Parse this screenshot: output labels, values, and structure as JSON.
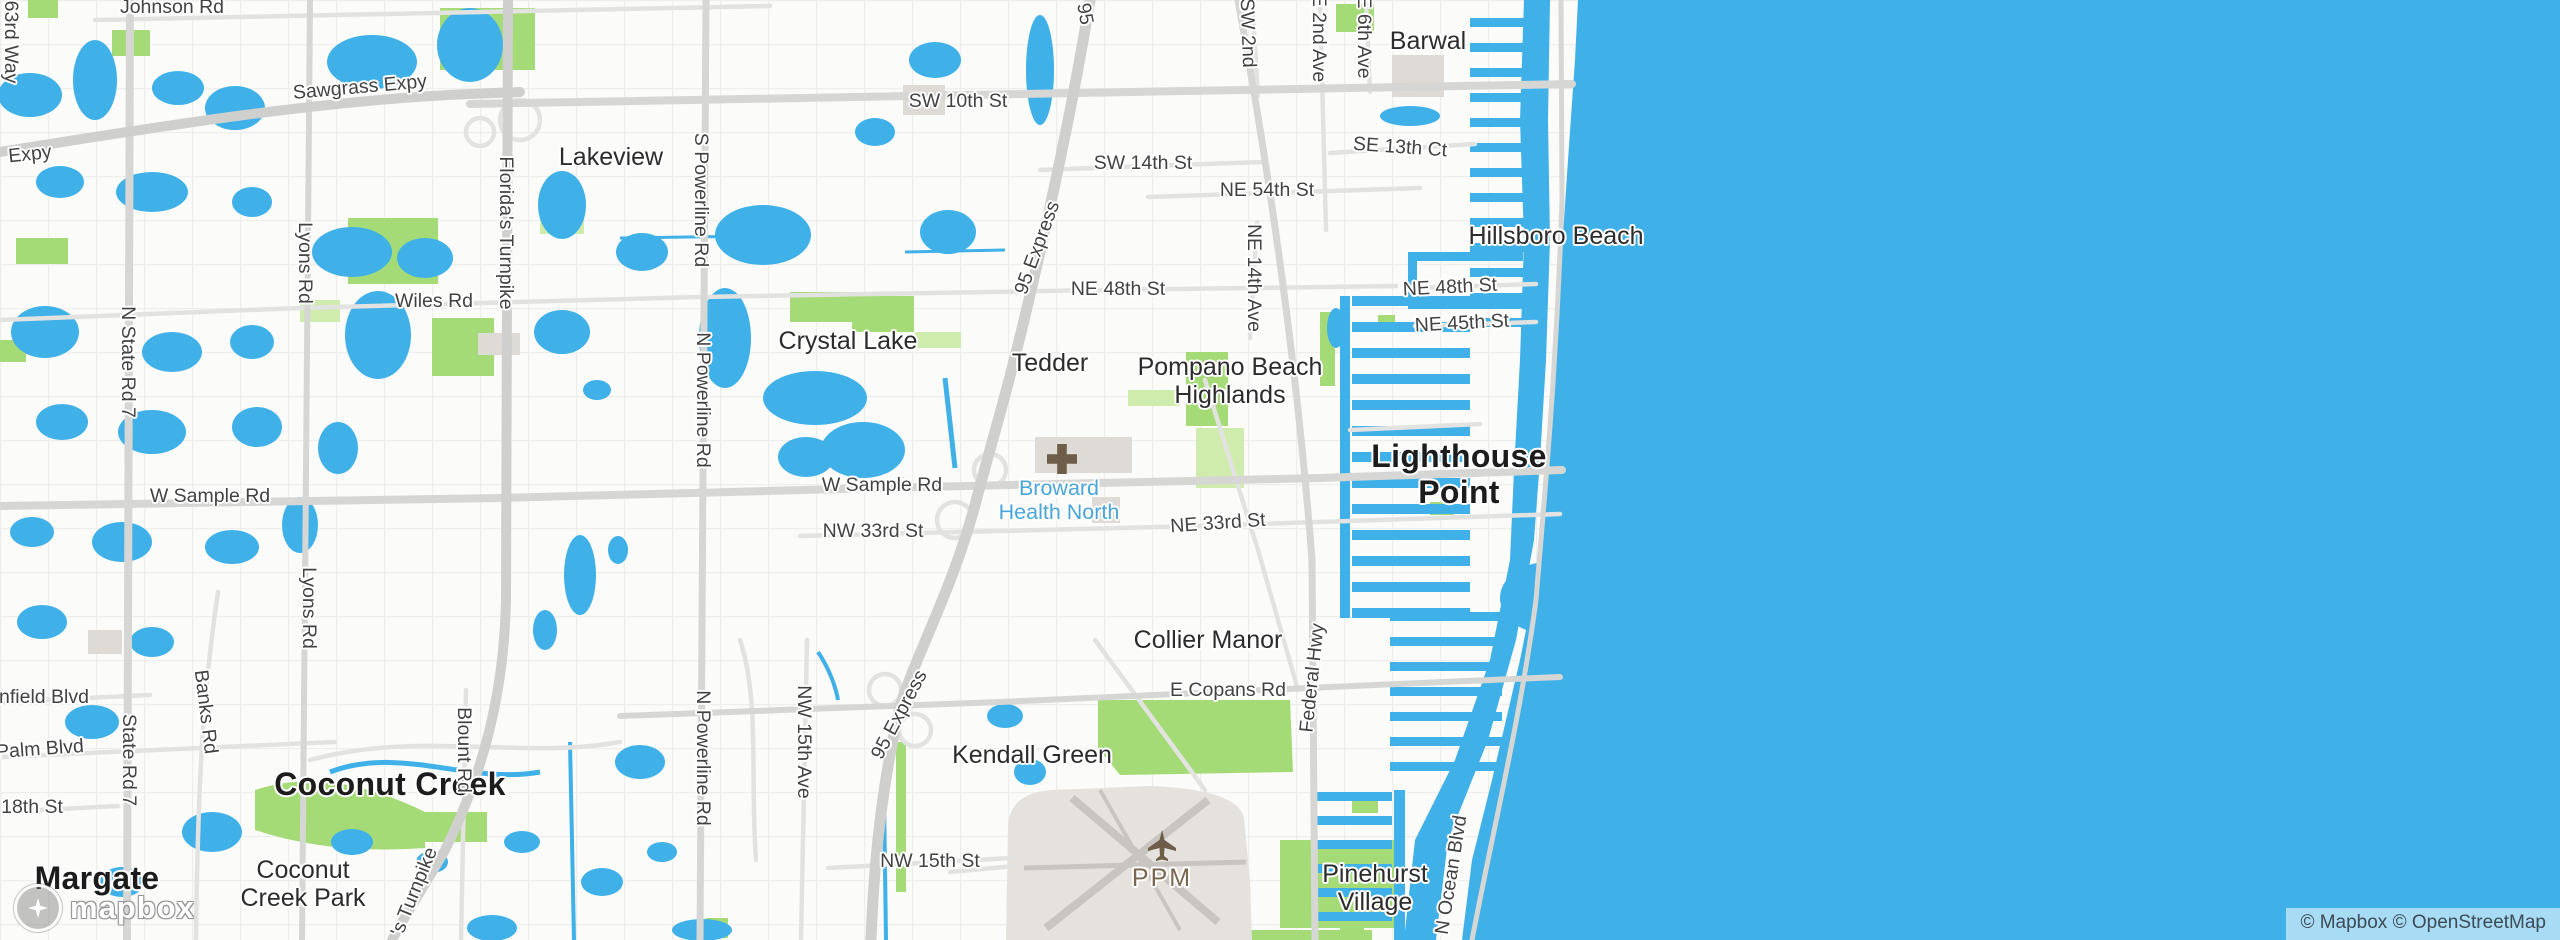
{
  "map": {
    "attribution": "© Mapbox © OpenStreetMap",
    "logo_text": "mapbox",
    "colors": {
      "water": "#3FB1E8",
      "land": "#FBFBF9",
      "park": "#A5DB76",
      "park_light": "#D0ECAD",
      "road": "#D6D6D4",
      "airport_ground": "#E5E2DE",
      "city_label": "#1c1c1c",
      "road_label": "#424242",
      "hospital_label": "#4AA5DA",
      "airport_label": "#7A6750",
      "poi_icon_brown": "#6E5E49"
    },
    "labels": [
      {
        "t": "Margate",
        "x": 97,
        "y": 879,
        "c": "city"
      },
      {
        "t": "Coconut Creek",
        "x": 390,
        "y": 785,
        "c": "city"
      },
      {
        "t": "Lighthouse\nPoint",
        "x": 1459,
        "y": 475,
        "c": "city"
      },
      {
        "t": "Barwal",
        "x": 1428,
        "y": 41,
        "c": "town"
      },
      {
        "t": "Hillsboro Beach",
        "x": 1556,
        "y": 236,
        "c": "town"
      },
      {
        "t": "Lakeview",
        "x": 611,
        "y": 157,
        "c": "town"
      },
      {
        "t": "Crystal Lake",
        "x": 848,
        "y": 341,
        "c": "town"
      },
      {
        "t": "Tedder",
        "x": 1050,
        "y": 363,
        "c": "town"
      },
      {
        "t": "Pompano Beach\nHighlands",
        "x": 1230,
        "y": 381,
        "c": "town"
      },
      {
        "t": "Collier Manor",
        "x": 1208,
        "y": 640,
        "c": "town"
      },
      {
        "t": "Kendall Green",
        "x": 1032,
        "y": 755,
        "c": "town"
      },
      {
        "t": "Coconut\nCreek Park",
        "x": 303,
        "y": 884,
        "c": "town"
      },
      {
        "t": "Pinehurst\nVillage",
        "x": 1375,
        "y": 888,
        "c": "town"
      },
      {
        "t": "Johnson Rd",
        "x": 172,
        "y": 8,
        "c": "road"
      },
      {
        "t": "Sawgrass Expy",
        "x": 360,
        "y": 88,
        "r": -5,
        "c": "road"
      },
      {
        "t": "Expy",
        "x": 30,
        "y": 155,
        "r": -6,
        "c": "road"
      },
      {
        "t": "SW 10th St",
        "x": 958,
        "y": 102,
        "c": "road"
      },
      {
        "t": "SW 14th St",
        "x": 1143,
        "y": 164,
        "c": "road"
      },
      {
        "t": "NE 54th St",
        "x": 1267,
        "y": 191,
        "c": "road"
      },
      {
        "t": "SE 13th Ct",
        "x": 1400,
        "y": 148,
        "r": 4,
        "c": "road"
      },
      {
        "t": "Wiles Rd",
        "x": 434,
        "y": 302,
        "c": "road"
      },
      {
        "t": "NE 48th St",
        "x": 1118,
        "y": 290,
        "c": "road"
      },
      {
        "t": "NE 48th St",
        "x": 1450,
        "y": 288,
        "r": -3,
        "c": "road"
      },
      {
        "t": "NE 45th St",
        "x": 1462,
        "y": 324,
        "r": -3,
        "c": "road"
      },
      {
        "t": "W Sample Rd",
        "x": 210,
        "y": 497,
        "c": "road"
      },
      {
        "t": "W Sample Rd",
        "x": 882,
        "y": 486,
        "c": "road"
      },
      {
        "t": "NW 33rd St",
        "x": 873,
        "y": 532,
        "c": "road"
      },
      {
        "t": "NE 33rd St",
        "x": 1218,
        "y": 524,
        "r": -4,
        "c": "road"
      },
      {
        "t": "E Copans Rd",
        "x": 1228,
        "y": 691,
        "c": "road"
      },
      {
        "t": "NW 15th St",
        "x": 930,
        "y": 862,
        "c": "road"
      },
      {
        "t": "18th St",
        "x": 32,
        "y": 808,
        "c": "road"
      },
      {
        "t": "nfield Blvd",
        "x": 44,
        "y": 698,
        "c": "road"
      },
      {
        "t": "Palm Blvd",
        "x": 40,
        "y": 750,
        "r": -4,
        "c": "road"
      },
      {
        "t": "63rd Way",
        "x": 10,
        "y": 42,
        "r": 90,
        "c": "road"
      },
      {
        "t": "N State Rd 7",
        "x": 127,
        "y": 362,
        "r": 90,
        "c": "road"
      },
      {
        "t": "State Rd 7",
        "x": 128,
        "y": 760,
        "r": 90,
        "c": "road"
      },
      {
        "t": "Lyons Rd",
        "x": 304,
        "y": 263,
        "r": 90,
        "c": "road"
      },
      {
        "t": "Lyons Rd",
        "x": 308,
        "y": 608,
        "r": 90,
        "c": "road"
      },
      {
        "t": "Banks Rd",
        "x": 205,
        "y": 712,
        "r": 83,
        "c": "road"
      },
      {
        "t": "Florida's Turnpike",
        "x": 505,
        "y": 233,
        "r": 90,
        "c": "road"
      },
      {
        "t": "'s Turnpike",
        "x": 415,
        "y": 892,
        "r": -68,
        "c": "road"
      },
      {
        "t": "Blount Rd",
        "x": 463,
        "y": 750,
        "r": 90,
        "c": "road"
      },
      {
        "t": "S Powerline Rd",
        "x": 700,
        "y": 200,
        "r": 90,
        "c": "road"
      },
      {
        "t": "N Powerline Rd",
        "x": 702,
        "y": 400,
        "r": 90,
        "c": "road"
      },
      {
        "t": "N Powerline Rd",
        "x": 702,
        "y": 758,
        "r": 90,
        "c": "road"
      },
      {
        "t": "NW 15th Ave",
        "x": 803,
        "y": 742,
        "r": 90,
        "c": "road"
      },
      {
        "t": "95",
        "x": 1084,
        "y": 14,
        "r": 80,
        "c": "road"
      },
      {
        "t": "95 Express",
        "x": 1038,
        "y": 248,
        "r": -70,
        "c": "road"
      },
      {
        "t": "95 Express",
        "x": 900,
        "y": 715,
        "r": -62,
        "c": "road"
      },
      {
        "t": "NE 14th Ave",
        "x": 1253,
        "y": 278,
        "r": 90,
        "c": "road"
      },
      {
        "t": "Federal Hwy",
        "x": 1313,
        "y": 678,
        "r": -84,
        "c": "road"
      },
      {
        "t": "E 2nd Ave",
        "x": 1318,
        "y": 38,
        "r": 90,
        "c": "road"
      },
      {
        "t": "E 6th Ave",
        "x": 1363,
        "y": 37,
        "r": 90,
        "c": "road"
      },
      {
        "t": "SW 2nd",
        "x": 1247,
        "y": 33,
        "r": 88,
        "c": "road"
      },
      {
        "t": "N Ocean Blvd",
        "x": 1452,
        "y": 875,
        "r": -81,
        "c": "road"
      },
      {
        "t": "Broward\nHealth North",
        "x": 1059,
        "y": 500,
        "c": "poi-blue"
      },
      {
        "n": "hospital-icon",
        "x": 1062,
        "y": 459,
        "c": "hospital-icon"
      },
      {
        "t": "PPM",
        "x": 1162,
        "y": 878,
        "c": "poi-brown"
      },
      {
        "n": "airplane-icon",
        "x": 1162,
        "y": 845,
        "c": "plane-icon"
      }
    ]
  }
}
